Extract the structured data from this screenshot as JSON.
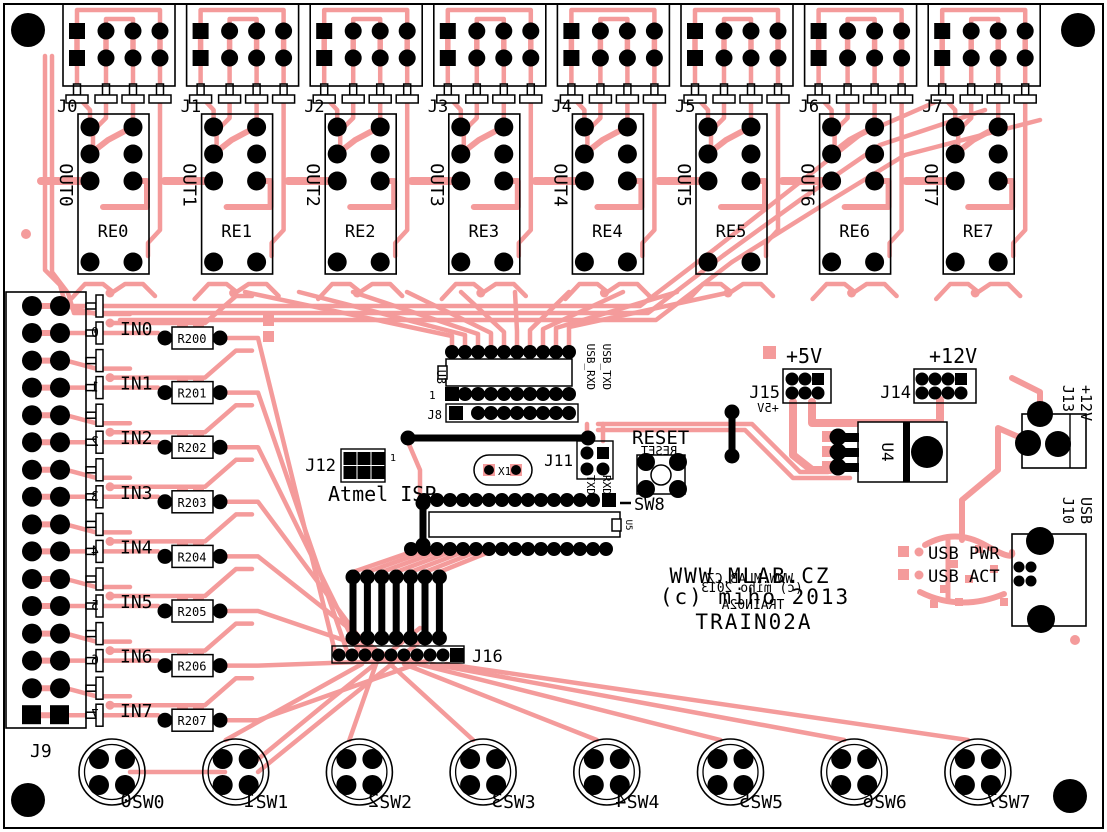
{
  "board": {
    "copper_color": "#F49B9B",
    "silk_color": "#000000",
    "title_lines": [
      "WWW.MLAB.CZ",
      "(c) miho 2013",
      "TRAIN02A"
    ],
    "mirror_title_lines": [
      "WWW.MLAB.CZ",
      "(c) miho 2013",
      "TRAIN02A"
    ]
  },
  "output_groups": [
    {
      "connector": "J0",
      "out": "OUT0",
      "relay": "RE0"
    },
    {
      "connector": "J1",
      "out": "OUT1",
      "relay": "RE1"
    },
    {
      "connector": "J2",
      "out": "OUT2",
      "relay": "RE2"
    },
    {
      "connector": "J3",
      "out": "OUT3",
      "relay": "RE3"
    },
    {
      "connector": "J4",
      "out": "OUT4",
      "relay": "RE4"
    },
    {
      "connector": "J5",
      "out": "OUT5",
      "relay": "RE5"
    },
    {
      "connector": "J6",
      "out": "OUT6",
      "relay": "RE6"
    },
    {
      "connector": "J7",
      "out": "OUT7",
      "relay": "RE7"
    }
  ],
  "inputs": [
    {
      "label": "IN0",
      "resistor": "R200",
      "digit": "0"
    },
    {
      "label": "IN1",
      "resistor": "R201",
      "digit": "1"
    },
    {
      "label": "IN2",
      "resistor": "R202",
      "digit": "2"
    },
    {
      "label": "IN3",
      "resistor": "R203",
      "digit": "3"
    },
    {
      "label": "IN4",
      "resistor": "R204",
      "digit": "4"
    },
    {
      "label": "IN5",
      "resistor": "R205",
      "digit": "5"
    },
    {
      "label": "IN6",
      "resistor": "R206",
      "digit": "6"
    },
    {
      "label": "IN7",
      "resistor": "R207",
      "digit": "7"
    }
  ],
  "switches": [
    {
      "label": "SW0",
      "digit": "0"
    },
    {
      "label": "SW1",
      "digit": "1"
    },
    {
      "label": "SW2",
      "digit": "2"
    },
    {
      "label": "SW3",
      "digit": "3"
    },
    {
      "label": "SW4",
      "digit": "4"
    },
    {
      "label": "SW5",
      "digit": "5"
    },
    {
      "label": "SW6",
      "digit": "6"
    },
    {
      "label": "SW7",
      "digit": "7"
    }
  ],
  "left_connector": {
    "label": "J9"
  },
  "jumper_header": {
    "label": "J16"
  },
  "isp": {
    "label": "J12",
    "caption": "Atmel ISP",
    "pin1": "1"
  },
  "uart_header": {
    "label": "J11",
    "top_labels": [
      "USB_RXD",
      "USB_TXD"
    ],
    "bottom_labels": [
      "TXD",
      "RXD"
    ]
  },
  "serial_header": {
    "label": "J8",
    "pin1": "1"
  },
  "ics": {
    "buffer": "U3",
    "mcu": "U5",
    "regulator": "U4"
  },
  "crystal": {
    "label": "X1"
  },
  "reset": {
    "label": "RESET",
    "switch_label": "SW8"
  },
  "power_5v": {
    "label": "J15",
    "voltage": "+5V"
  },
  "power_12v": {
    "label": "J14",
    "voltage": "+12V"
  },
  "dc_input": {
    "label": "J13",
    "voltage": "+12V"
  },
  "usb": {
    "label": "J10",
    "type": "USB",
    "led_labels": [
      "USB PWR",
      "USB ACT"
    ]
  }
}
